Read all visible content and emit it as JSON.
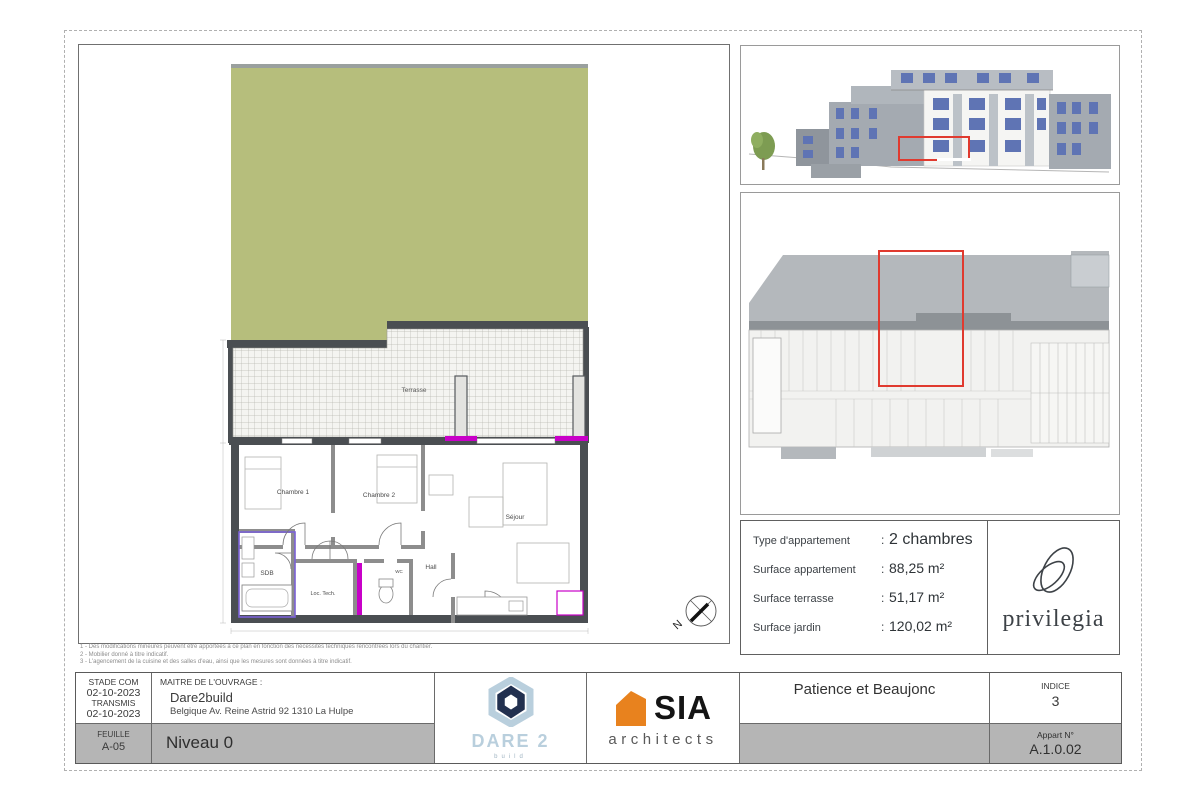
{
  "plan": {
    "labels": {
      "terrasse": "Terrasse",
      "chambre1": "Chambre 1",
      "chambre2": "Chambre 2",
      "sejour": "Séjour",
      "hall": "Hall",
      "sdb": "SDB",
      "loc_tech": "Loc. Tech.",
      "wc": "WC",
      "north": "N"
    },
    "colors": {
      "garden_green": "#b6be7c",
      "wall_dark": "#4a4e52",
      "window_magenta": "#c800c8",
      "highlight_violet": "#7b61d6",
      "highlight_red": "#e03a2f"
    }
  },
  "notes": {
    "line1": "1 - Des modifications mineures peuvent être apportées à ce plan en fonction des nécessités techniques rencontrées lors du chantier.",
    "line2": "2 - Mobilier donné à titre indicatif.",
    "line3": "3 - L'agencement de la cuisine et des salles d'eau, ainsi que les mesures sont données à titre indicatif."
  },
  "info_panel": {
    "colon": ":",
    "rows": [
      {
        "label": "Type d'appartement",
        "value": "2 chambres"
      },
      {
        "label": "Surface appartement",
        "value": "88,25 m²"
      },
      {
        "label": "Surface terrasse",
        "value": "51,17 m²"
      },
      {
        "label": "Surface jardin",
        "value": "120,02 m²"
      }
    ],
    "brand": "privilegia"
  },
  "title_block": {
    "stade_label": "STADE COM",
    "stade_date": "02-10-2023",
    "transmis_label": "TRANSMIS",
    "transmis_date": "02-10-2023",
    "feuille_label": "FEUILLE",
    "feuille_value": "A-05",
    "maitre_label": "MAITRE DE L'OUVRAGE :",
    "maitre_name": "Dare2build",
    "maitre_address": "Belgique Av. Reine Astrid 92   1310 La Hulpe",
    "niveau": "Niveau 0",
    "dare2_name": "DARE 2",
    "dare2_sub": "build",
    "sia_name": "SIA",
    "sia_sub": "architects",
    "project": "Patience et Beaujonc",
    "indice_label": "INDICE",
    "indice_value": "3",
    "appart_label": "Appart N°",
    "appart_value": "A.1.0.02"
  }
}
